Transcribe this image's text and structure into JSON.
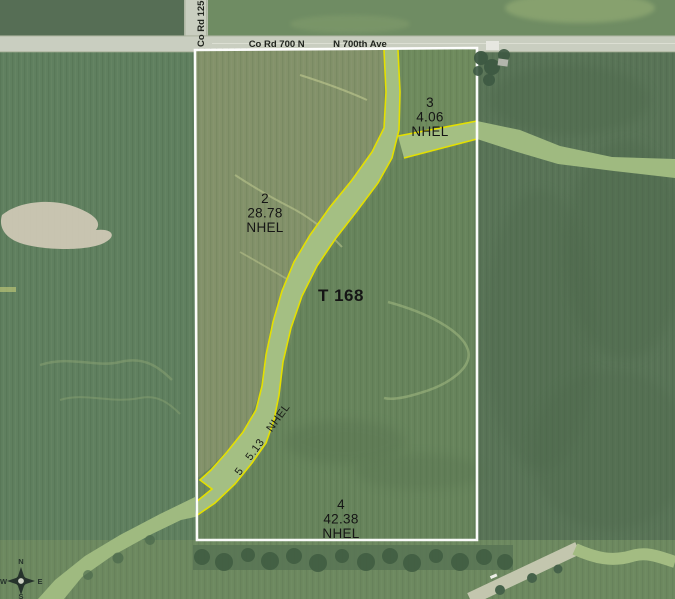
{
  "roads": {
    "top_name_left": "Co Rd 700 N",
    "top_name_right": "N 700th Ave",
    "left_vertical_name": "Co Rd 1250"
  },
  "tract": {
    "label": "T 168"
  },
  "parcels": [
    {
      "id": "2",
      "acres": "28.78",
      "designation": "NHEL"
    },
    {
      "id": "3",
      "acres": "4.06",
      "designation": "NHEL"
    },
    {
      "id": "4",
      "acres": "42.38",
      "designation": "NHEL"
    },
    {
      "id": "5",
      "acres": "5.13",
      "designation": "NHEL"
    }
  ],
  "compass": {
    "north": "N",
    "east": "E",
    "south": "S",
    "west": "W"
  },
  "colors": {
    "boundary_line": "#ffffff",
    "waterway_outline_yellow": "#e4e000",
    "waterway_fill": "#a4bf83",
    "road_fill": "#c9cec0",
    "label_text": "#151515"
  }
}
